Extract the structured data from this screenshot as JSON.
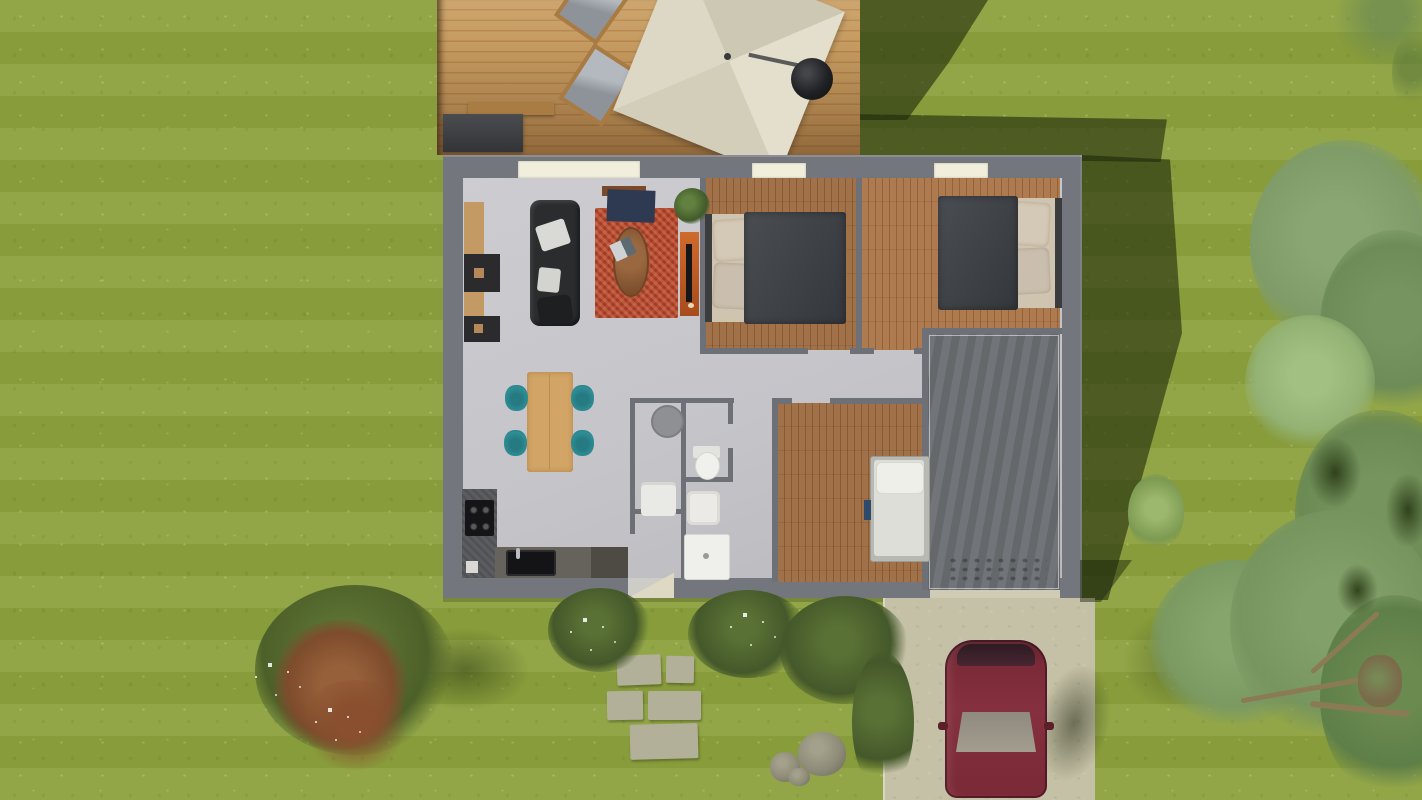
{
  "scene": {
    "description": "Top-down 3D architectural render of a single-storey house with wooden deck, garden, lawn, driveway and parked car",
    "canvas": {
      "width": 1422,
      "height": 800
    }
  },
  "palette": {
    "grass": "#8da13f",
    "grass_shadow": "rgba(27,38,11,0.58)",
    "deck_wood": "#b98a52",
    "house_wall": "#73767c",
    "interior_floor": "#c7c7cb",
    "bedroom_parquet": "#9d6d42",
    "garage_concrete": "#6b6e72",
    "window_frame": "#f1efdc",
    "rug_red": "#b04a31",
    "sofa_charcoal": "#2a2c2e",
    "dining_table_wood": "#d2a567",
    "chair_teal": "#2f8e96",
    "tv_stand_orange": "#bf5b24",
    "kitchen_counter": "#55565a",
    "bed_duvet": "#43464a",
    "bed_pillow": "#c9bda9",
    "single_bed_white": "#deded9",
    "bathroom_white": "#ebebe8",
    "parasol_cream": "#dcd8c5",
    "car_burgundy": "#7c2a38",
    "driveway_concrete": "#c5c1a6",
    "stepping_stone": "#b3b09a",
    "tree_foliage": "#7f9c68",
    "bush_dark_green": "#44582a",
    "bush_red_brown": "#96603a"
  },
  "rooms": {
    "living_room": "sofa, red patterned rug, oval coffee table, TV cabinet, shelving, house plant",
    "kitchen": "L-shaped counter, induction cooktop, black sink, dining table with 4 teal chairs",
    "bedroom_1": "double bed, dark duvet, beige pillows, parquet floor",
    "bedroom_2": "double bed, dark duvet, beige pillows, parquet floor",
    "bedroom_3": "single white bed, parquet floor",
    "bathroom": "round basin, washing machine, toilet, washbasin, shower tray",
    "garage": "dark concrete floor",
    "deck": "lounge chairs, cantilever parasol, barbecue grill, outdoor bench"
  },
  "objects": {
    "parasol": "square cream cantilever parasol",
    "bbq_grill": "round black kettle barbecue",
    "lounge_chairs": "2 wooden lounge chairs with grey cushions",
    "car": "burgundy hatchback parked on driveway facing street",
    "stepping_stones": "5 rectangular pavers from front door",
    "rocks": "3 grey boulders",
    "tree": "large deciduous tree overhanging right lawn",
    "bushes": "flowering shrubs along south wall and red-leaf ornamental bush at lower left"
  }
}
